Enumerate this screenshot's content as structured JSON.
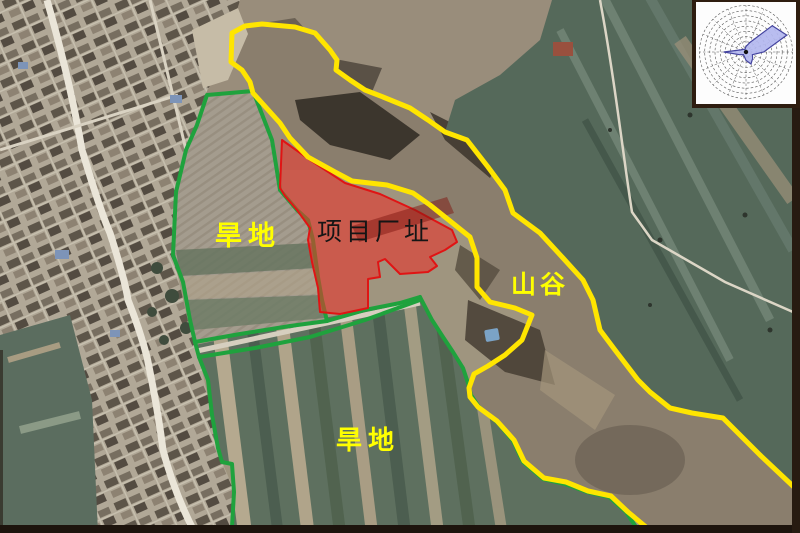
{
  "map_figure": {
    "labels": {
      "dry_land_upper": "旱地",
      "project_site": "项目厂址",
      "valley": "山谷",
      "dry_land_lower": "旱地"
    },
    "colors": {
      "site_fill_red": "#e8322a",
      "site_boundary_red": "#e01414",
      "farmland_boundary_green": "#1fa23d",
      "valley_boundary_yellow": "#ffe500",
      "label_yellow": "#ffff00",
      "label_black": "#151515"
    }
  },
  "wind_rose": {
    "type": "rose",
    "petal_color": "#b3b7ef",
    "petal_outline": "#4444a0",
    "directions": [
      "N",
      "NNE",
      "NE",
      "ENE",
      "E",
      "ESE",
      "SE",
      "SSE",
      "S",
      "SSW",
      "SW",
      "WSW",
      "W",
      "WNW",
      "NW",
      "NNW"
    ],
    "values_pct": [
      12,
      22,
      80,
      95,
      38,
      15,
      20,
      28,
      18,
      10,
      8,
      15,
      48,
      12,
      8,
      6
    ]
  }
}
